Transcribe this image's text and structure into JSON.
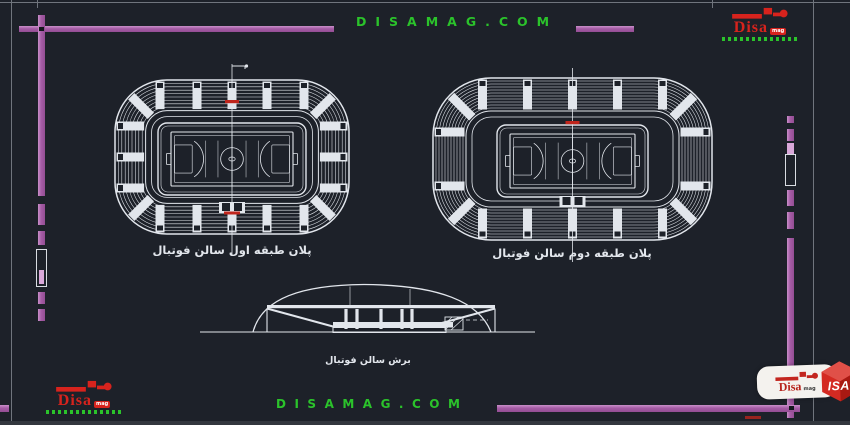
{
  "site": {
    "top_banner": "DISAMAG.COM",
    "bottom_banner": "DISAMAG.COM"
  },
  "logo": {
    "brand": "Disa",
    "suffix": "mag"
  },
  "watermark": {
    "brand": "Disa",
    "suffix": "mag",
    "cube": "ISA"
  },
  "drawings": {
    "plan_first": {
      "label": "پلان طبقه اول سالن فوتبال"
    },
    "plan_second": {
      "label": "پلان طبقه دوم سالن فوتبال"
    },
    "section": {
      "label": "برش سالن فوتبال"
    }
  },
  "colors": {
    "background": "#1d2129",
    "frame_purple": "#a55ca5",
    "frame_purple_light": "#d9a8d9",
    "brand_green": "#2bc32b",
    "brand_red": "#d7231d",
    "draw_white": "#e2e6ec",
    "accent_red_dash": "#c0251c",
    "thin_gray": "#70757d",
    "bottom_strip": "#33373e"
  }
}
